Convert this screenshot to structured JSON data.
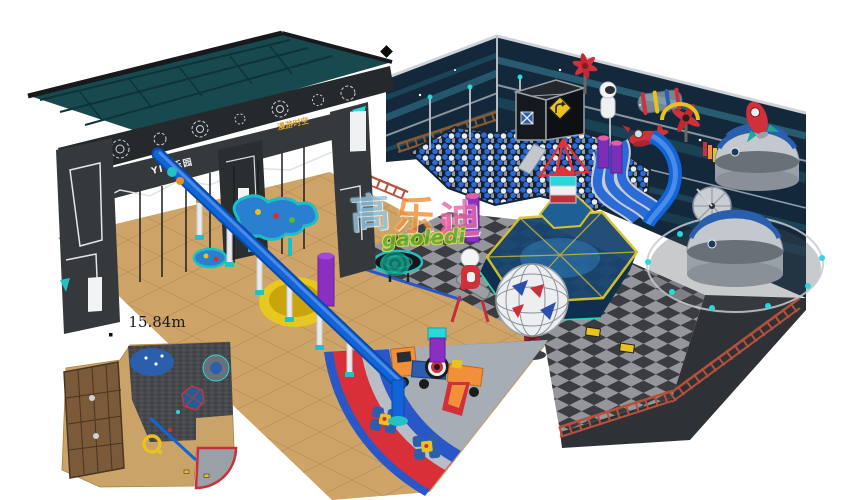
{
  "scene": {
    "kind": "3d-render",
    "subject": "space-themed indoor playground design render",
    "background": "#ffffff"
  },
  "signs": {
    "gate_sign": "YIQ乐园",
    "beam_sign": "漫游时空"
  },
  "watermark": {
    "cjk_chars": [
      "高",
      "乐",
      "迪"
    ],
    "latin": "gaoledi"
  },
  "inset": {
    "dimension_label": "15.84m"
  },
  "palette": {
    "wall_navy": "#13293b",
    "wall_streak_teal": "#3d8ea6",
    "roof_teal": "#17494f",
    "structure_charcoal": "#35393c",
    "floor_tan": "#cfa468",
    "floor_tile_line": "#b58b52",
    "checker_dark": "#3b3c40",
    "checker_light": "#95969b",
    "ball_blue": "#2b6bd8",
    "ball_white": "#e9edf2",
    "accent_red": "#d82f38",
    "accent_blue": "#2a57c8",
    "pad_silver": "#b9bec5",
    "fan_floor": "#a7adb4",
    "slide_blue": "#1265d8",
    "dome_gray": "#c2c8ce",
    "dome_stripe": "#2b5fae",
    "railing_red": "#b5503c",
    "wood_rail": "#8a5a32",
    "yellow": "#e8c21f",
    "purple": "#8b2fc0",
    "teal": "#23c0c4"
  }
}
